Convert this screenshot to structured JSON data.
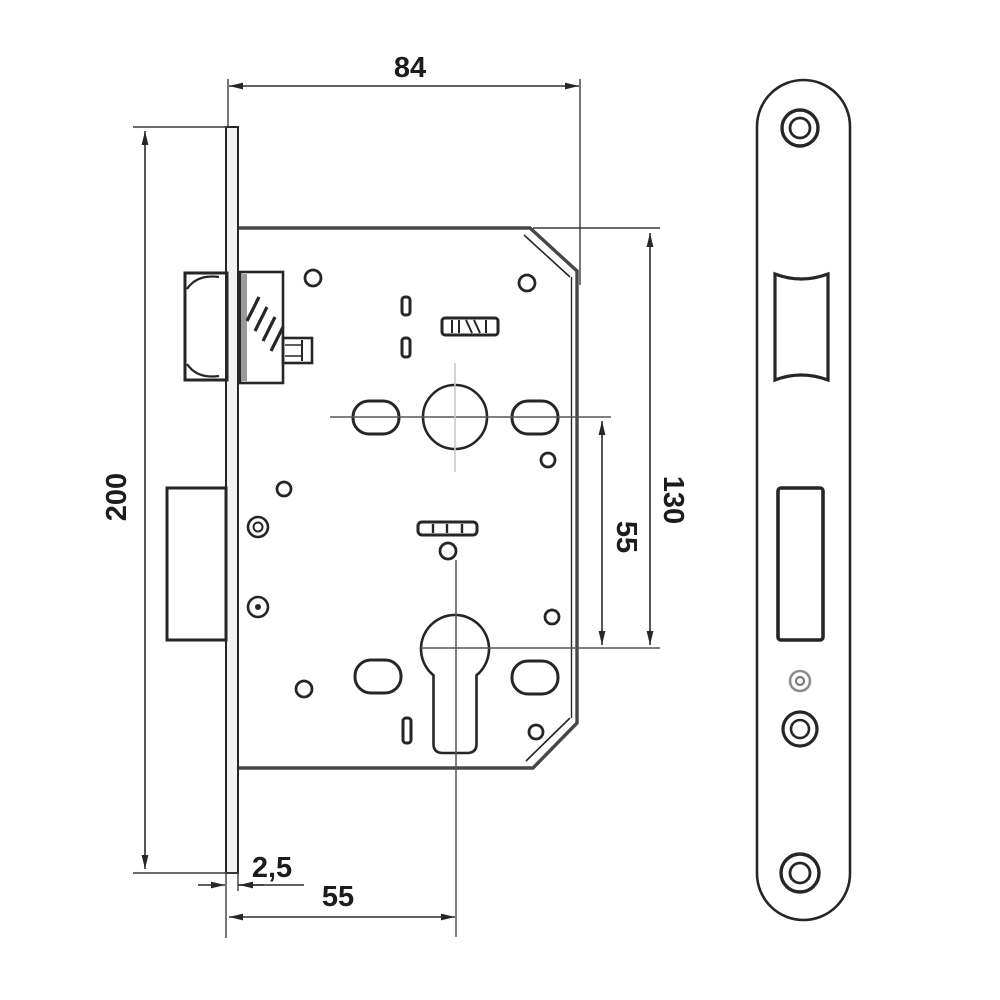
{
  "drawing": {
    "title": "Mortise lock technical drawing",
    "views": {
      "side_view": "lock case with faceplate, latch bolt, deadbolt and euro cylinder hole",
      "front_view": "rounded faceplate with latch and deadbolt cutouts and screw holes"
    },
    "dimensions": {
      "case_width": "84",
      "faceplate_height": "200",
      "case_height": "130",
      "axis_distance": "55",
      "backset": "55",
      "faceplate_thickness": "2,5"
    },
    "colors": {
      "line": "#262626",
      "case_line": "#474747",
      "centerline_light": "#c9c9c9",
      "centerline_dark": "#565656",
      "background": "#ffffff",
      "text": "#1c1c1c"
    }
  }
}
